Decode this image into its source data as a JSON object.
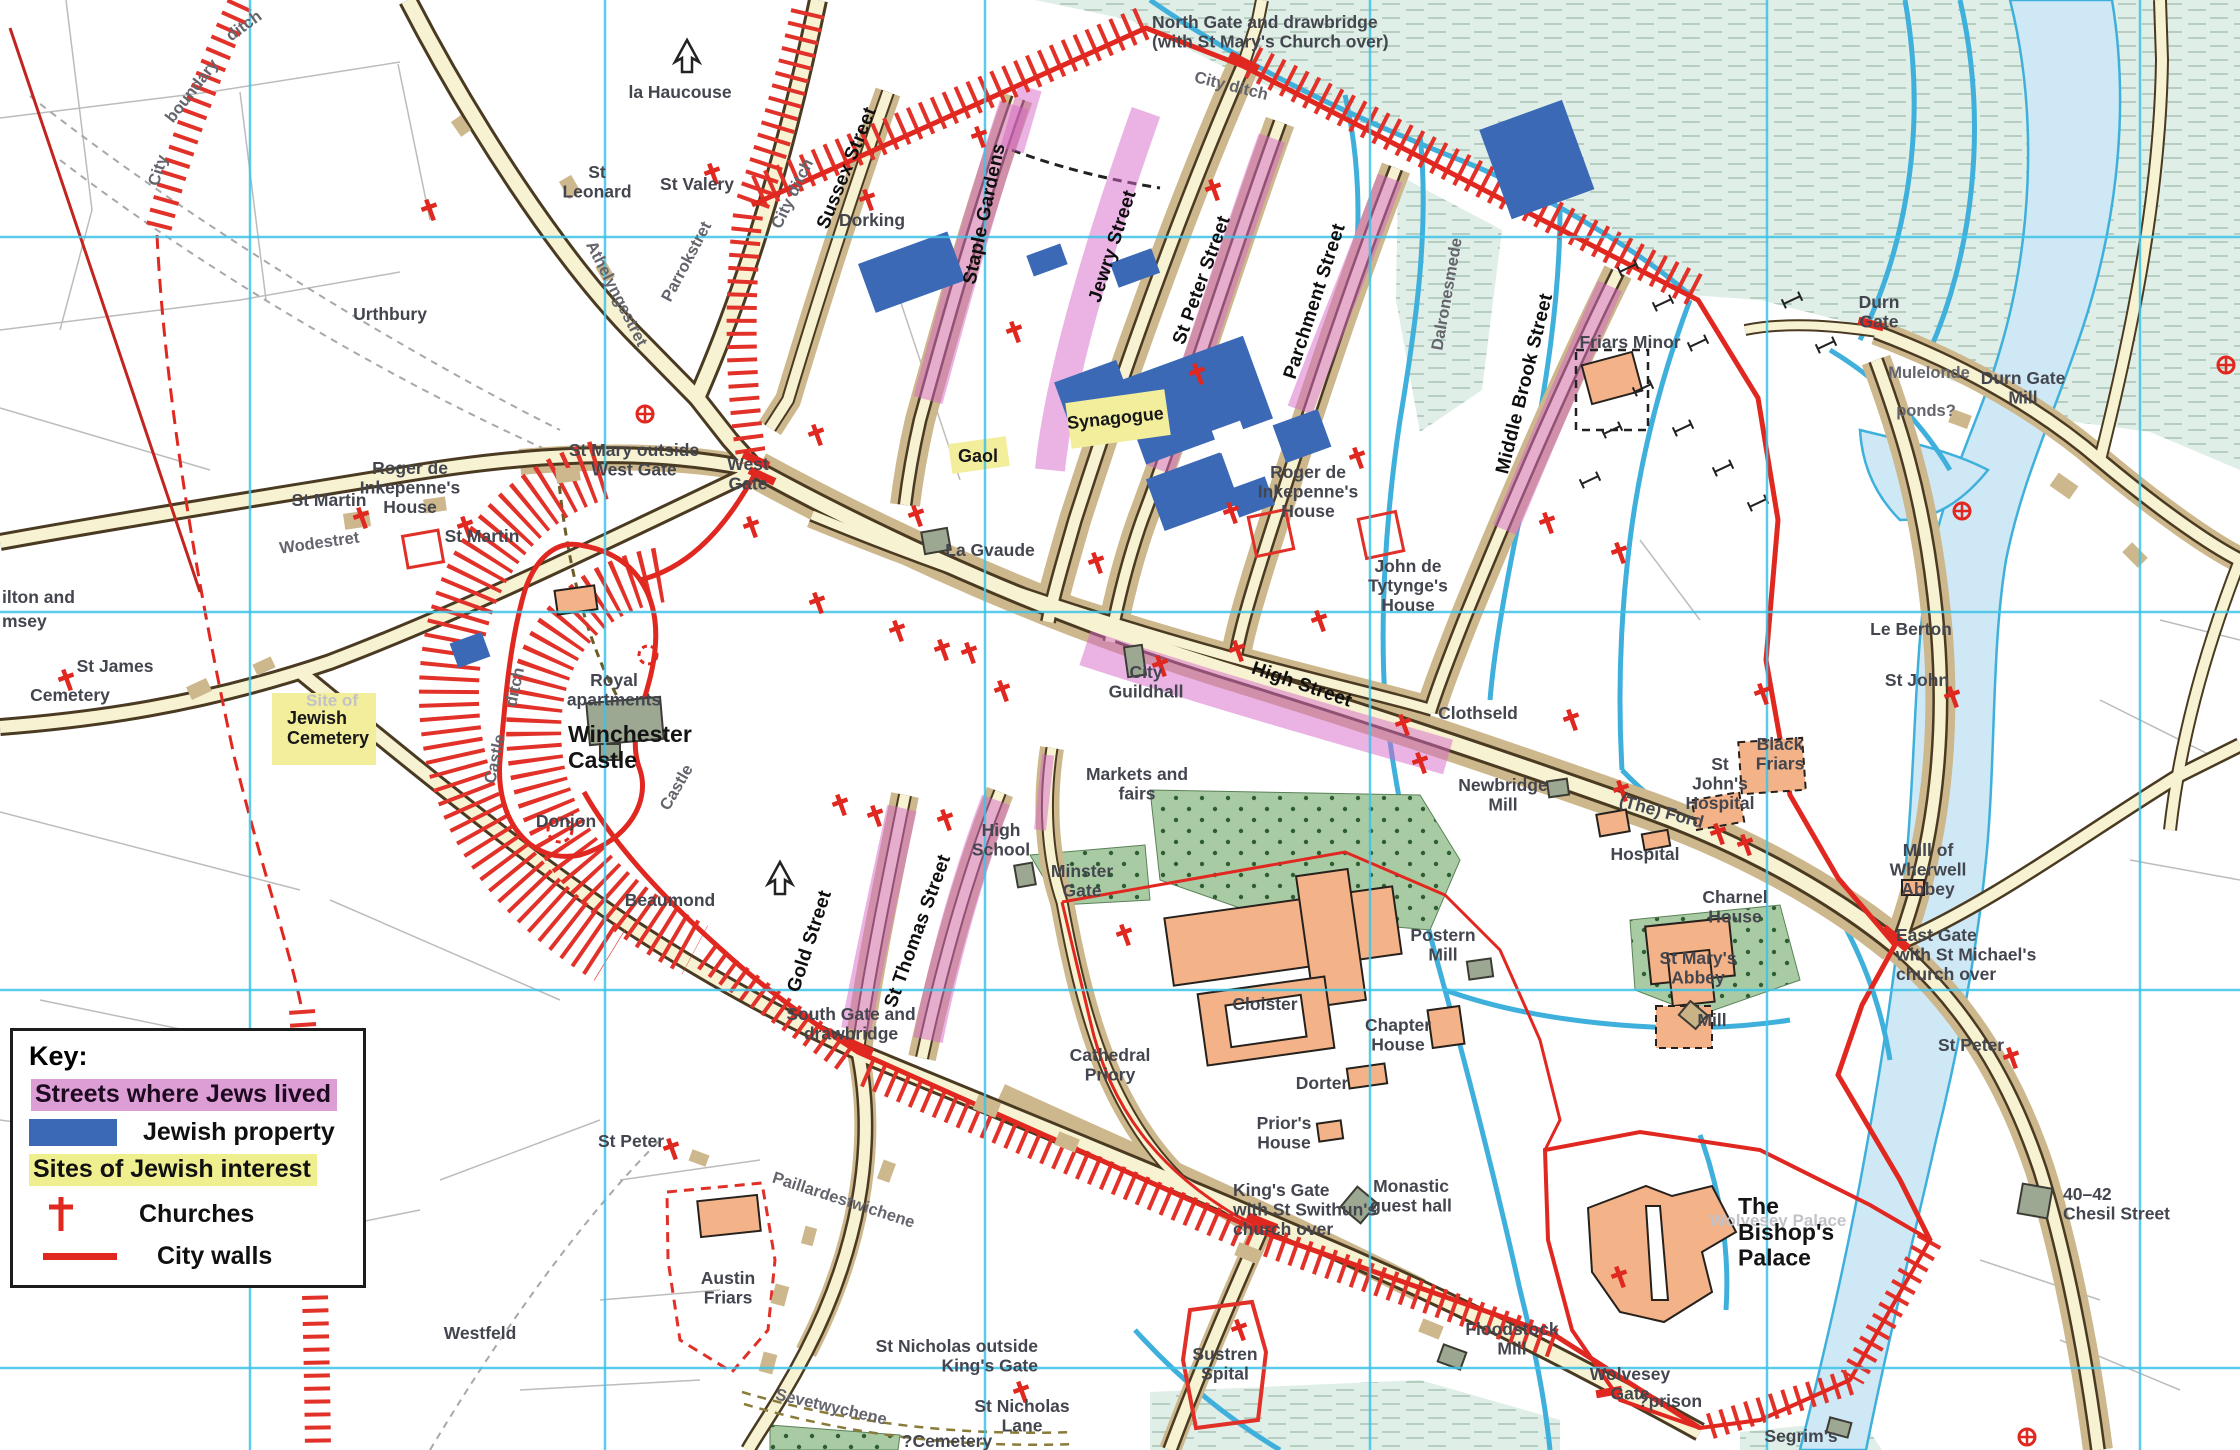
{
  "legend": {
    "title": "Key:",
    "items": [
      {
        "id": "jews-streets",
        "label": "Streets where Jews lived",
        "swatch": "pink-highlight",
        "color": "#dd9ed6"
      },
      {
        "id": "jewish-property",
        "label": "Jewish property",
        "swatch": "blue-rect",
        "color": "#3b69b5"
      },
      {
        "id": "jewish-sites",
        "label": "Sites of Jewish interest",
        "swatch": "yellow-highlight",
        "color": "#efef8f"
      },
      {
        "id": "churches",
        "label": "Churches",
        "swatch": "red-cross",
        "color": "#e02820"
      },
      {
        "id": "city-walls",
        "label": "City walls",
        "swatch": "red-line",
        "color": "#e02820"
      }
    ]
  },
  "colors": {
    "jewish_streets": "#dd9ed6",
    "jewish_property": "#3b69b5",
    "jewish_sites": "#efef8f",
    "churches_walls": "#e02820",
    "water_line": "#3fb0dc",
    "water_fill": "#cfe8f5",
    "grid": "#3ec3e8",
    "road_fill": "#f7f2d2",
    "frontage": "#cdb78c",
    "monastic": "#f3b288",
    "meadow": "#dfeee6",
    "green": "#a9cba4"
  },
  "grid": {
    "vertical_x": [
      250,
      605,
      985,
      1370,
      1767,
      2140
    ],
    "horizontal_y": [
      237,
      612,
      990,
      1368
    ]
  },
  "church_crosses": [
    [
      430,
      210
    ],
    [
      713,
      174
    ],
    [
      868,
      200
    ],
    [
      980,
      137
    ],
    [
      1015,
      332
    ],
    [
      1214,
      190
    ],
    [
      1198,
      374
    ],
    [
      817,
      435
    ],
    [
      752,
      527
    ],
    [
      917,
      516
    ],
    [
      818,
      603
    ],
    [
      898,
      631
    ],
    [
      943,
      650
    ],
    [
      970,
      653
    ],
    [
      1003,
      691
    ],
    [
      1358,
      458
    ],
    [
      1232,
      513
    ],
    [
      1097,
      563
    ],
    [
      1320,
      621
    ],
    [
      1238,
      651
    ],
    [
      1404,
      725
    ],
    [
      1548,
      523
    ],
    [
      1161,
      666
    ],
    [
      1620,
      553
    ],
    [
      1763,
      694
    ],
    [
      1622,
      791
    ],
    [
      1719,
      834
    ],
    [
      1421,
      763
    ],
    [
      1572,
      720
    ],
    [
      1746,
      845
    ],
    [
      841,
      805
    ],
    [
      876,
      816
    ],
    [
      946,
      820
    ],
    [
      1125,
      935
    ],
    [
      1240,
      1330
    ],
    [
      1620,
      1277
    ],
    [
      2012,
      1058
    ],
    [
      672,
      1149
    ],
    [
      1022,
      1392
    ],
    [
      362,
      518
    ],
    [
      466,
      527
    ],
    [
      67,
      680
    ],
    [
      1953,
      697
    ]
  ],
  "circle_churches": [
    [
      645,
      414
    ],
    [
      1962,
      511
    ],
    [
      2027,
      1437
    ],
    [
      2226,
      365
    ]
  ],
  "labels": [
    {
      "t": "City",
      "x": 163,
      "y": 172,
      "r": -72,
      "c": "sg"
    },
    {
      "t": "boundary",
      "x": 196,
      "y": 94,
      "r": -52,
      "c": "sg"
    },
    {
      "t": "ditch",
      "x": 247,
      "y": 30,
      "r": -36,
      "c": "sg"
    },
    {
      "t": "la Haucouse",
      "x": 680,
      "y": 98,
      "c": "p"
    },
    {
      "t": "St\nLeonard",
      "x": 597,
      "y": 178,
      "c": "p"
    },
    {
      "t": "St Valery",
      "x": 697,
      "y": 190,
      "c": "p"
    },
    {
      "t": "Urthbury",
      "x": 390,
      "y": 320,
      "c": "p"
    },
    {
      "t": "Athelyngestret",
      "x": 612,
      "y": 296,
      "r": 63,
      "c": "sg"
    },
    {
      "t": "Parrokstret",
      "x": 691,
      "y": 264,
      "r": -62,
      "c": "sg"
    },
    {
      "t": "City ditch",
      "x": 797,
      "y": 196,
      "r": -64,
      "c": "sg"
    },
    {
      "t": "City ditch",
      "x": 1230,
      "y": 91,
      "r": 14,
      "c": "sg"
    },
    {
      "t": "North Gate and drawbridge\n(with St Mary's Church over)",
      "x": 1152,
      "y": 28,
      "a": "start",
      "c": "p"
    },
    {
      "t": "Sussex Street",
      "x": 852,
      "y": 170,
      "r": -68,
      "c": "sb"
    },
    {
      "t": "Dorking",
      "x": 872,
      "y": 226,
      "c": "p"
    },
    {
      "t": "Staple Gardens",
      "x": 990,
      "y": 215,
      "r": -78,
      "c": "sb"
    },
    {
      "t": "Jewry Street",
      "x": 1118,
      "y": 248,
      "r": -72,
      "c": "sb"
    },
    {
      "t": "St Peter Street",
      "x": 1207,
      "y": 282,
      "r": -70,
      "c": "sb"
    },
    {
      "t": "Parchment Street",
      "x": 1320,
      "y": 303,
      "r": -72,
      "c": "sb"
    },
    {
      "t": "Middle Brook Street",
      "x": 1530,
      "y": 385,
      "r": -76,
      "c": "sb"
    },
    {
      "t": "Dalronesmede",
      "x": 1452,
      "y": 295,
      "r": -80,
      "c": "sg"
    },
    {
      "t": "Friars Minor",
      "x": 1630,
      "y": 348,
      "c": "p"
    },
    {
      "t": "Durn\nGate",
      "x": 1879,
      "y": 308,
      "c": "p"
    },
    {
      "t": "Mulelonde",
      "x": 1929,
      "y": 378,
      "c": "sg"
    },
    {
      "t": "ponds?",
      "x": 1926,
      "y": 416,
      "c": "sg"
    },
    {
      "t": "Durn Gate\nMill",
      "x": 2023,
      "y": 384,
      "c": "p"
    },
    {
      "t": "St Mary outside\nWest Gate",
      "x": 634,
      "y": 456,
      "c": "p"
    },
    {
      "t": "West\nGate",
      "x": 748,
      "y": 470,
      "c": "p"
    },
    {
      "t": "Roger de\nInkepenne's\nHouse",
      "x": 410,
      "y": 474,
      "c": "p"
    },
    {
      "t": "St Martin",
      "x": 329,
      "y": 506,
      "c": "p"
    },
    {
      "t": "St Martin",
      "x": 482,
      "y": 542,
      "c": "p"
    },
    {
      "t": "Wodestret",
      "x": 320,
      "y": 548,
      "r": -8,
      "c": "sg"
    },
    {
      "t": "ilton and",
      "x": 2,
      "y": 603,
      "a": "start",
      "c": "p"
    },
    {
      "t": "msey",
      "x": 2,
      "y": 627,
      "a": "start",
      "c": "p"
    },
    {
      "t": "St James",
      "x": 115,
      "y": 672,
      "c": "p"
    },
    {
      "t": "Cemetery",
      "x": 70,
      "y": 701,
      "c": "p"
    },
    {
      "t": "Site of",
      "x": 332,
      "y": 706,
      "c": "faint"
    },
    {
      "t": "Jewish\nCemetery",
      "x": 287,
      "y": 724,
      "a": "start",
      "c": "site"
    },
    {
      "t": "Royal\napartments",
      "x": 614,
      "y": 686,
      "c": "p"
    },
    {
      "t": "Winchester\nCastle",
      "x": 568,
      "y": 742,
      "a": "start",
      "c": "pb"
    },
    {
      "t": "Donjon",
      "x": 566,
      "y": 827,
      "c": "p"
    },
    {
      "t": "Beaumond",
      "x": 670,
      "y": 906,
      "c": "p"
    },
    {
      "t": "ditch",
      "x": 520,
      "y": 688,
      "r": -78,
      "c": "sg"
    },
    {
      "t": "Castle",
      "x": 500,
      "y": 760,
      "r": -78,
      "c": "sg"
    },
    {
      "t": "Castle",
      "x": 681,
      "y": 790,
      "r": -60,
      "c": "sg"
    },
    {
      "t": "Gaol",
      "x": 978,
      "y": 462,
      "c": "site"
    },
    {
      "t": "Synagogue",
      "x": 1116,
      "y": 424,
      "r": -6,
      "c": "site"
    },
    {
      "t": "La Gvaude",
      "x": 990,
      "y": 556,
      "c": "p"
    },
    {
      "t": "Roger de\nInkepenne's\nHouse",
      "x": 1308,
      "y": 478,
      "c": "p"
    },
    {
      "t": "John de\nTytynge's\nHouse",
      "x": 1408,
      "y": 572,
      "c": "p"
    },
    {
      "t": "City\nGuildhall",
      "x": 1146,
      "y": 678,
      "c": "p"
    },
    {
      "t": "High Street",
      "x": 1300,
      "y": 690,
      "r": 19,
      "c": "sb"
    },
    {
      "t": "Clothseld",
      "x": 1478,
      "y": 719,
      "c": "p"
    },
    {
      "t": "Markets and\nfairs",
      "x": 1137,
      "y": 780,
      "c": "p"
    },
    {
      "t": "High\nSchool",
      "x": 1001,
      "y": 836,
      "c": "p"
    },
    {
      "t": "Minster\nGate",
      "x": 1082,
      "y": 877,
      "c": "p"
    },
    {
      "t": "Gold Street",
      "x": 815,
      "y": 943,
      "r": -72,
      "c": "sb"
    },
    {
      "t": "St Thomas Street",
      "x": 923,
      "y": 933,
      "r": -70,
      "c": "sb"
    },
    {
      "t": "South Gate and\ndrawbridge",
      "x": 851,
      "y": 1020,
      "c": "p"
    },
    {
      "t": "Cloister",
      "x": 1265,
      "y": 1010,
      "c": "p"
    },
    {
      "t": "Cathedral\nPriory",
      "x": 1110,
      "y": 1061,
      "c": "p"
    },
    {
      "t": "Dorter",
      "x": 1322,
      "y": 1089,
      "c": "p"
    },
    {
      "t": "Prior's\nHouse",
      "x": 1284,
      "y": 1129,
      "c": "p"
    },
    {
      "t": "King's Gate\nwith St Swithun's\nchurch over",
      "x": 1233,
      "y": 1196,
      "a": "start",
      "c": "p"
    },
    {
      "t": "Monastic\nguest hall",
      "x": 1411,
      "y": 1192,
      "c": "p"
    },
    {
      "t": "Sustren\nSpital",
      "x": 1225,
      "y": 1360,
      "c": "p"
    },
    {
      "t": "Floodstock\nMill",
      "x": 1512,
      "y": 1335,
      "c": "p"
    },
    {
      "t": "Wolvesey\nGate",
      "x": 1630,
      "y": 1380,
      "c": "p"
    },
    {
      "t": "?prison",
      "x": 1670,
      "y": 1407,
      "c": "p"
    },
    {
      "t": "Wolvesey Palace",
      "x": 1778,
      "y": 1226,
      "c": "faint"
    },
    {
      "t": "The\nBishop's\nPalace",
      "x": 1738,
      "y": 1214,
      "a": "start",
      "c": "pb"
    },
    {
      "t": "Segrim's",
      "x": 1801,
      "y": 1442,
      "c": "p"
    },
    {
      "t": "Newbridge\nMill",
      "x": 1503,
      "y": 791,
      "c": "p"
    },
    {
      "t": "(The) Ford",
      "x": 1660,
      "y": 817,
      "r": 15,
      "c": "p"
    },
    {
      "t": "Hospital",
      "x": 1645,
      "y": 860,
      "c": "p"
    },
    {
      "t": "Charnel\nHouse",
      "x": 1735,
      "y": 903,
      "c": "p"
    },
    {
      "t": "St Mary's\nAbbey",
      "x": 1698,
      "y": 964,
      "c": "p"
    },
    {
      "t": "Postern\nMill",
      "x": 1443,
      "y": 941,
      "c": "p"
    },
    {
      "t": "Chapter\nHouse",
      "x": 1398,
      "y": 1031,
      "c": "p"
    },
    {
      "t": "Mill",
      "x": 1712,
      "y": 1026,
      "c": "p"
    },
    {
      "t": "St\nJohn's\nHospital",
      "x": 1720,
      "y": 770,
      "c": "p"
    },
    {
      "t": "Black\nFriars",
      "x": 1780,
      "y": 750,
      "c": "p"
    },
    {
      "t": "Le Berton",
      "x": 1911,
      "y": 635,
      "c": "p"
    },
    {
      "t": "St John",
      "x": 1917,
      "y": 686,
      "c": "p"
    },
    {
      "t": "Mill of\nWherwell\nAbbey",
      "x": 1928,
      "y": 856,
      "c": "p"
    },
    {
      "t": "East Gate\nwith St Michael's\nchurch over",
      "x": 1896,
      "y": 941,
      "a": "start",
      "c": "p"
    },
    {
      "t": "St Peter",
      "x": 1971,
      "y": 1051,
      "c": "p"
    },
    {
      "t": "40–42\nChesil Street",
      "x": 2063,
      "y": 1200,
      "a": "start",
      "c": "p"
    },
    {
      "t": "St Peter",
      "x": 631,
      "y": 1147,
      "c": "p"
    },
    {
      "t": "Paillardestwichene",
      "x": 842,
      "y": 1205,
      "r": 18,
      "c": "sg"
    },
    {
      "t": "Austin\nFriars",
      "x": 728,
      "y": 1284,
      "c": "p"
    },
    {
      "t": "Westfeld",
      "x": 480,
      "y": 1339,
      "c": "p"
    },
    {
      "t": "Sevetwychene",
      "x": 830,
      "y": 1412,
      "r": 13,
      "c": "sg"
    },
    {
      "t": "?Cemetery",
      "x": 947,
      "y": 1447,
      "c": "p"
    },
    {
      "t": "St Nicholas outside\nKing's Gate",
      "x": 1038,
      "y": 1352,
      "a": "end",
      "c": "p"
    },
    {
      "t": "St Nicholas\nLane",
      "x": 1022,
      "y": 1412,
      "c": "p"
    },
    {
      "t": "boundary",
      "x": 312,
      "y": 1185,
      "r": -85,
      "c": "sg"
    }
  ]
}
